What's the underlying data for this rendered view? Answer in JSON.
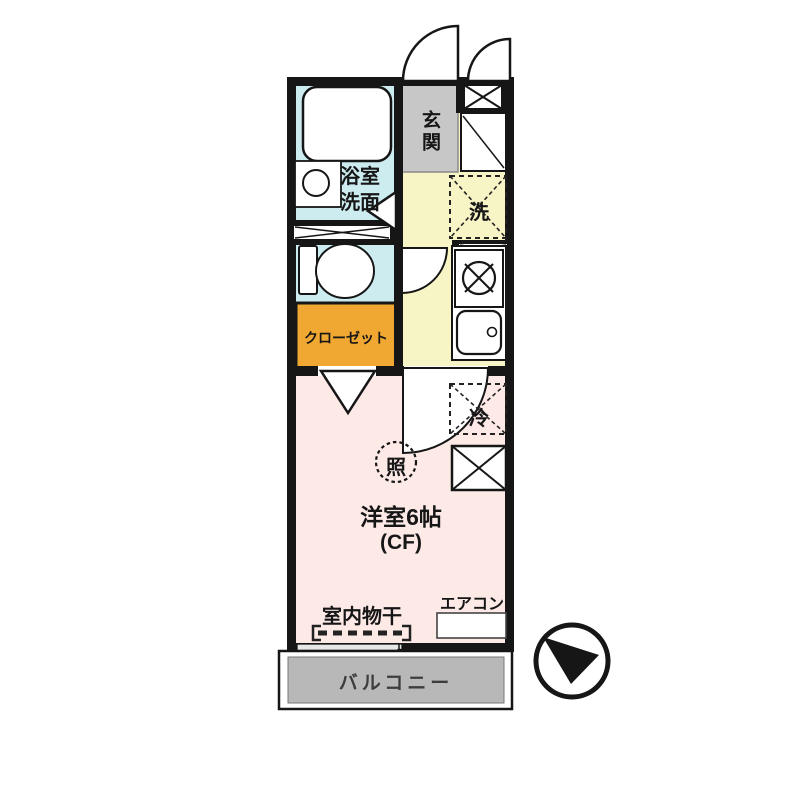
{
  "floorplan": {
    "type": "japanese-apartment-floor-plan",
    "labels": {
      "bathroom_line1": "浴室",
      "bathroom_line2": "洗面",
      "entrance": "玄関",
      "washer": "洗",
      "closet": "クローゼット",
      "light": "照",
      "main_room": "洋室6帖",
      "flooring": "(CF)",
      "fridge": "冷",
      "indoor_drying": "室内物干",
      "aircon": "エアコン",
      "balcony": "バルコニー"
    },
    "colors": {
      "wall": "#161616",
      "bathroom": "#cdecf0",
      "toilet": "#cdecf0",
      "hallway": "#f7f4c5",
      "entrance": "#c7c7c7",
      "closet": "#f0a832",
      "main_room": "#fdeae7",
      "balcony": "#b8b8b8"
    }
  }
}
